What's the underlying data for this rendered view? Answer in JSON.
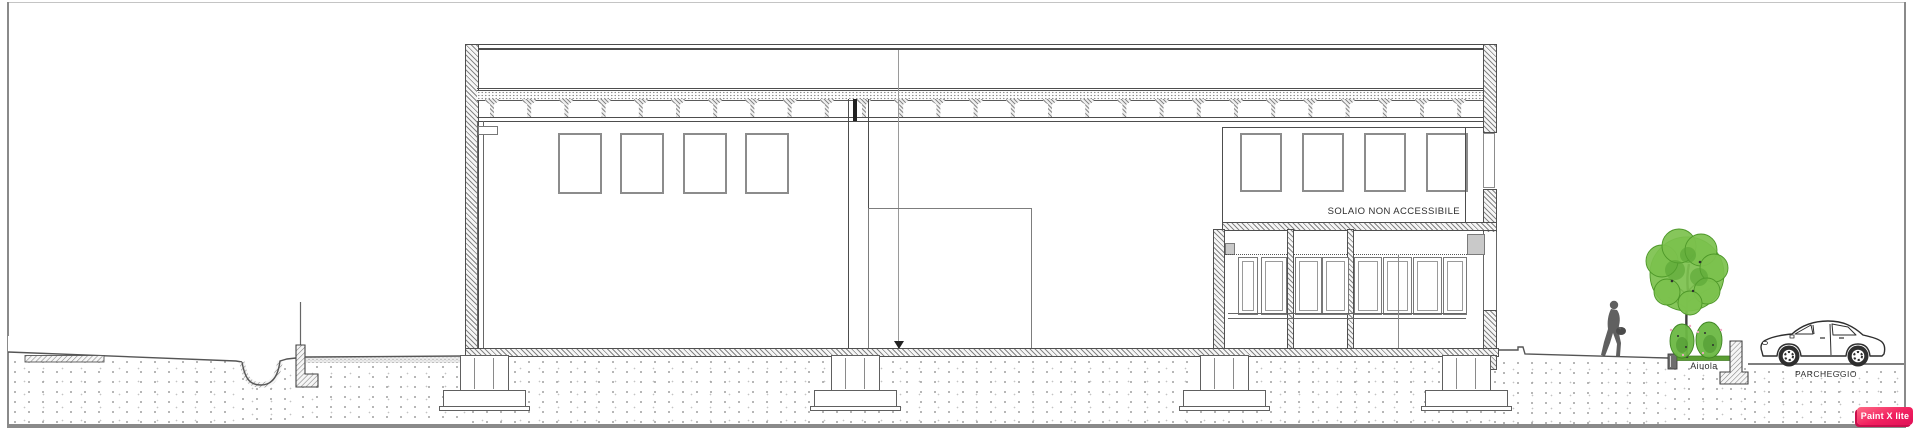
{
  "app": {
    "watermark_label": "Paint X lite",
    "watermark_color_top": "#ff6b86",
    "watermark_color_bottom": "#e01057"
  },
  "annotations": {
    "solaio": "SOLAIO NON ACCESSIBILE",
    "aiuola": "Aiuola",
    "parcheggio": "PARCHEGGIO"
  },
  "palette": {
    "line": "#4d4d4d",
    "window_frame": "#8c8c8c",
    "soil_dot": "#9f9f9f",
    "tree_foliage": "#7cc14d",
    "tree_foliage_dark": "#55a231",
    "shrub_green": "#6bb843",
    "flower_pink": "#f2a9c4",
    "aiuola_strip": "#5a9e32"
  },
  "structure": {
    "upper_windows_left": {
      "y": 133,
      "w": 40,
      "h": 57,
      "x": [
        558,
        620,
        683,
        745
      ]
    },
    "upper_windows_right": {
      "y": 133,
      "w": 38,
      "h": 55,
      "x": [
        1240,
        1302,
        1364,
        1426
      ]
    },
    "roof_joists": {
      "count": 27,
      "start": 485,
      "spacing": 37.2,
      "y": 99
    },
    "glazing_panes": {
      "y": 257,
      "h": 56,
      "items": [
        [
          1238,
          18
        ],
        [
          1261,
          24
        ],
        [
          1295,
          25
        ],
        [
          1322,
          25
        ],
        [
          1354,
          26
        ],
        [
          1383,
          27
        ],
        [
          1413,
          27
        ],
        [
          1443,
          22
        ]
      ]
    },
    "mullions": [
      1287,
      1347
    ],
    "foundations": {
      "centers": [
        485,
        856,
        1225,
        1467
      ]
    }
  }
}
